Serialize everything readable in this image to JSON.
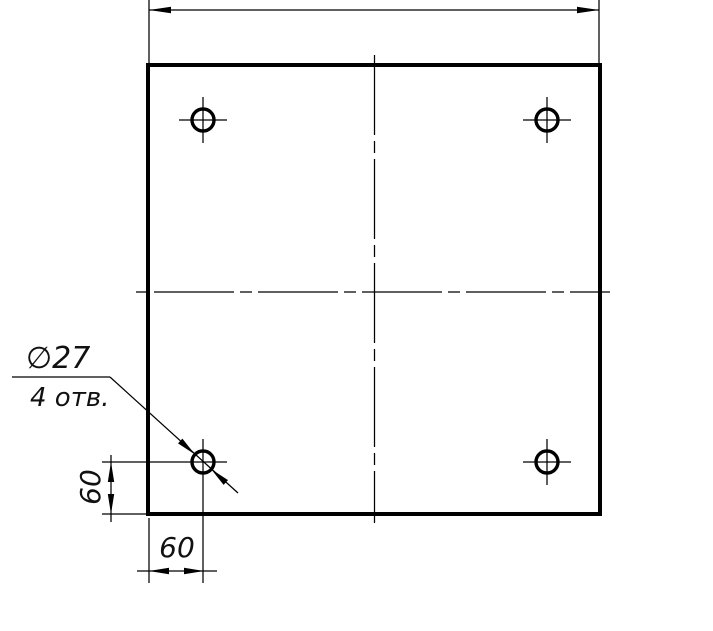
{
  "drawing_labels": {
    "diameter": "∅27",
    "holes_note": "4 отв.",
    "offset_left": "60",
    "offset_bottom": "60"
  },
  "colors": {
    "line": "#000000",
    "background": "#ffffff"
  }
}
